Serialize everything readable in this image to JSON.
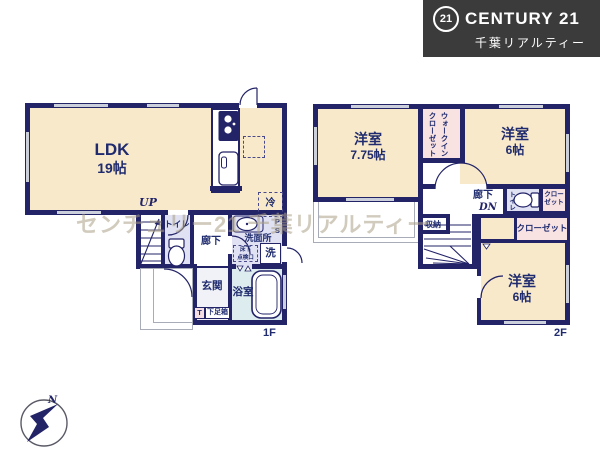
{
  "brand": {
    "badge": "21",
    "name": "CENTURY 21",
    "subtitle": "千葉リアルティー"
  },
  "watermark": "センチュリー21 千葉リアルティー",
  "compass": {
    "north_label": "N"
  },
  "floor1": {
    "floor_label": "1F",
    "ldk_name": "LDK",
    "ldk_size": "19帖",
    "up_label": "UP",
    "toilet_label": "トイレ",
    "hall_label": "廊下",
    "washroom_label": "洗面所",
    "hatch_line1": "床下",
    "hatch_line2": "点検口",
    "washer_label": "洗",
    "ps_label": "PS",
    "entrance_label": "玄関",
    "shoe_t_label": "T",
    "shoe_box_label": "下足箱",
    "bath_label": "浴室",
    "fridge_label": "冷"
  },
  "floor2": {
    "floor_label": "2F",
    "room_a_name": "洋室",
    "room_a_size": "7.75帖",
    "wic_line1": "ウォークイン",
    "wic_line2": "クローゼット",
    "room_b_name": "洋室",
    "room_b_size": "6帖",
    "hall_label": "廊下",
    "dn_label": "DN",
    "storage_label": "収納",
    "toilet_label": "トイレ",
    "closet_a_line1": "クロー",
    "closet_a_line2": "ゼット",
    "closet_b_label": "クローゼット",
    "room_c_name": "洋室",
    "room_c_size": "6帖"
  }
}
